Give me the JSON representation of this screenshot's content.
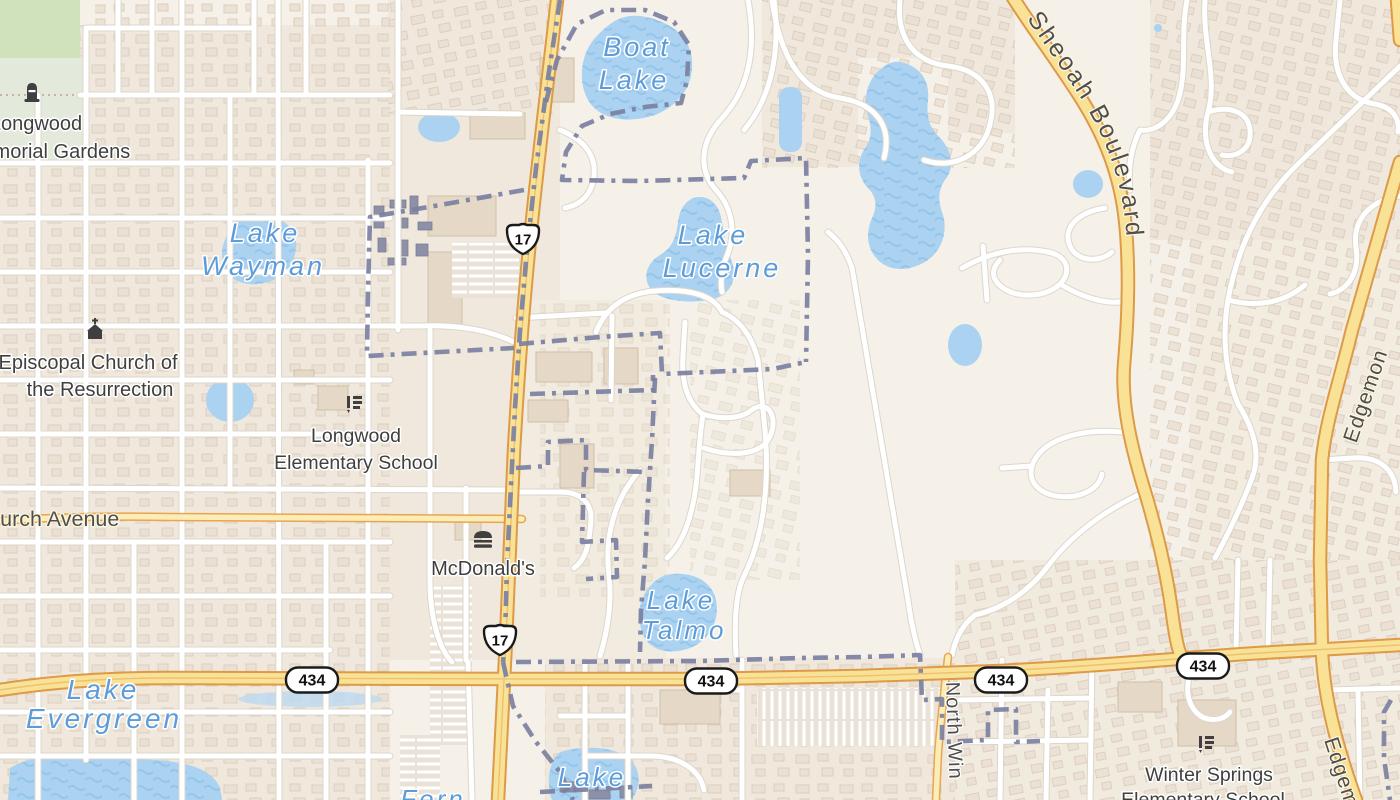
{
  "water_labels": {
    "boat": {
      "line1": "Boat",
      "line2": "Lake"
    },
    "wayman": {
      "line1": "Lake",
      "line2": "Wayman"
    },
    "lucerne": {
      "line1": "Lake",
      "line2": "Lucerne"
    },
    "talmo": {
      "line1": "Lake",
      "line2": "Talmo"
    },
    "evergreen": {
      "line1": "Lake",
      "line2": "Evergreen"
    },
    "south": {
      "line1": "Lake"
    },
    "fern": {
      "line1": "Fern"
    }
  },
  "poi_labels": {
    "memorial": {
      "line1": "Longwood",
      "line2": "Memorial Gardens"
    },
    "episcopal": {
      "line1": "Episcopal Church of",
      "line2": "the Resurrection"
    },
    "longwood_school": {
      "line1": "Longwood",
      "line2": "Elementary School"
    },
    "mcdonalds": {
      "label": "McDonald's"
    },
    "winter_springs_school": {
      "line1": "Winter Springs",
      "line2": "Elementary School"
    }
  },
  "street_labels": {
    "church": "Church Avenue",
    "sheoah": "Sheoah Boulevard",
    "north": "North Win",
    "edgemon_upper": "Edgemon",
    "edgemon_lower": "Edgemon"
  },
  "shields": {
    "us17": "17",
    "sr434": "434"
  },
  "colors": {
    "background": "#f5f1e9",
    "water": "#abd3f1",
    "water_label": "#5d9cd9",
    "road_primary": "#f9e296",
    "road_primary_casing": "#dd9a48",
    "boundary": "#7b80a1",
    "green_area": "#cfe2bc",
    "label": "#3f3f3f"
  }
}
